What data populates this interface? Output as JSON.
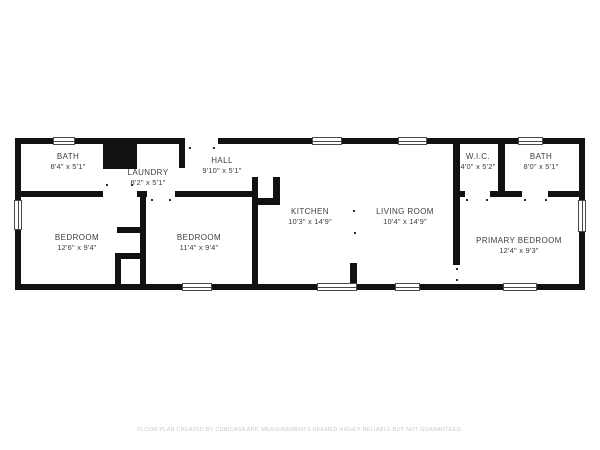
{
  "colors": {
    "background": "#ffffff",
    "wall": "#111111",
    "label": "#3d3d3d",
    "window_frame": "#4a4a4a",
    "caption": "#c8c8c8"
  },
  "rooms": [
    {
      "id": "bath-1",
      "name": "BATH",
      "dims": "8'4\" x 5'1\""
    },
    {
      "id": "laundry",
      "name": "LAUNDRY",
      "dims": "8'2\" x 5'1\""
    },
    {
      "id": "hall",
      "name": "HALL",
      "dims": "9'10\" x 5'1\""
    },
    {
      "id": "wic",
      "name": "W.I.C.",
      "dims": "4'0\" x 5'2\""
    },
    {
      "id": "bath-2",
      "name": "BATH",
      "dims": "8'0\" x 5'1\""
    },
    {
      "id": "bedroom-1",
      "name": "BEDROOM",
      "dims": "12'6\" x 9'4\""
    },
    {
      "id": "bedroom-2",
      "name": "BEDROOM",
      "dims": "11'4\" x 9'4\""
    },
    {
      "id": "kitchen",
      "name": "KITCHEN",
      "dims": "10'3\" x 14'9\""
    },
    {
      "id": "living-room",
      "name": "LIVING ROOM",
      "dims": "10'4\" x 14'9\""
    },
    {
      "id": "primary-bedroom",
      "name": "PRIMARY BEDROOM",
      "dims": "12'4\" x 9'3\""
    }
  ],
  "caption": "FLOOR PLAN CREATED BY CUBICASA APP. MEASUREMENTS DEEMED HIGHLY RELIABLE BUT NOT GUARANTEED."
}
